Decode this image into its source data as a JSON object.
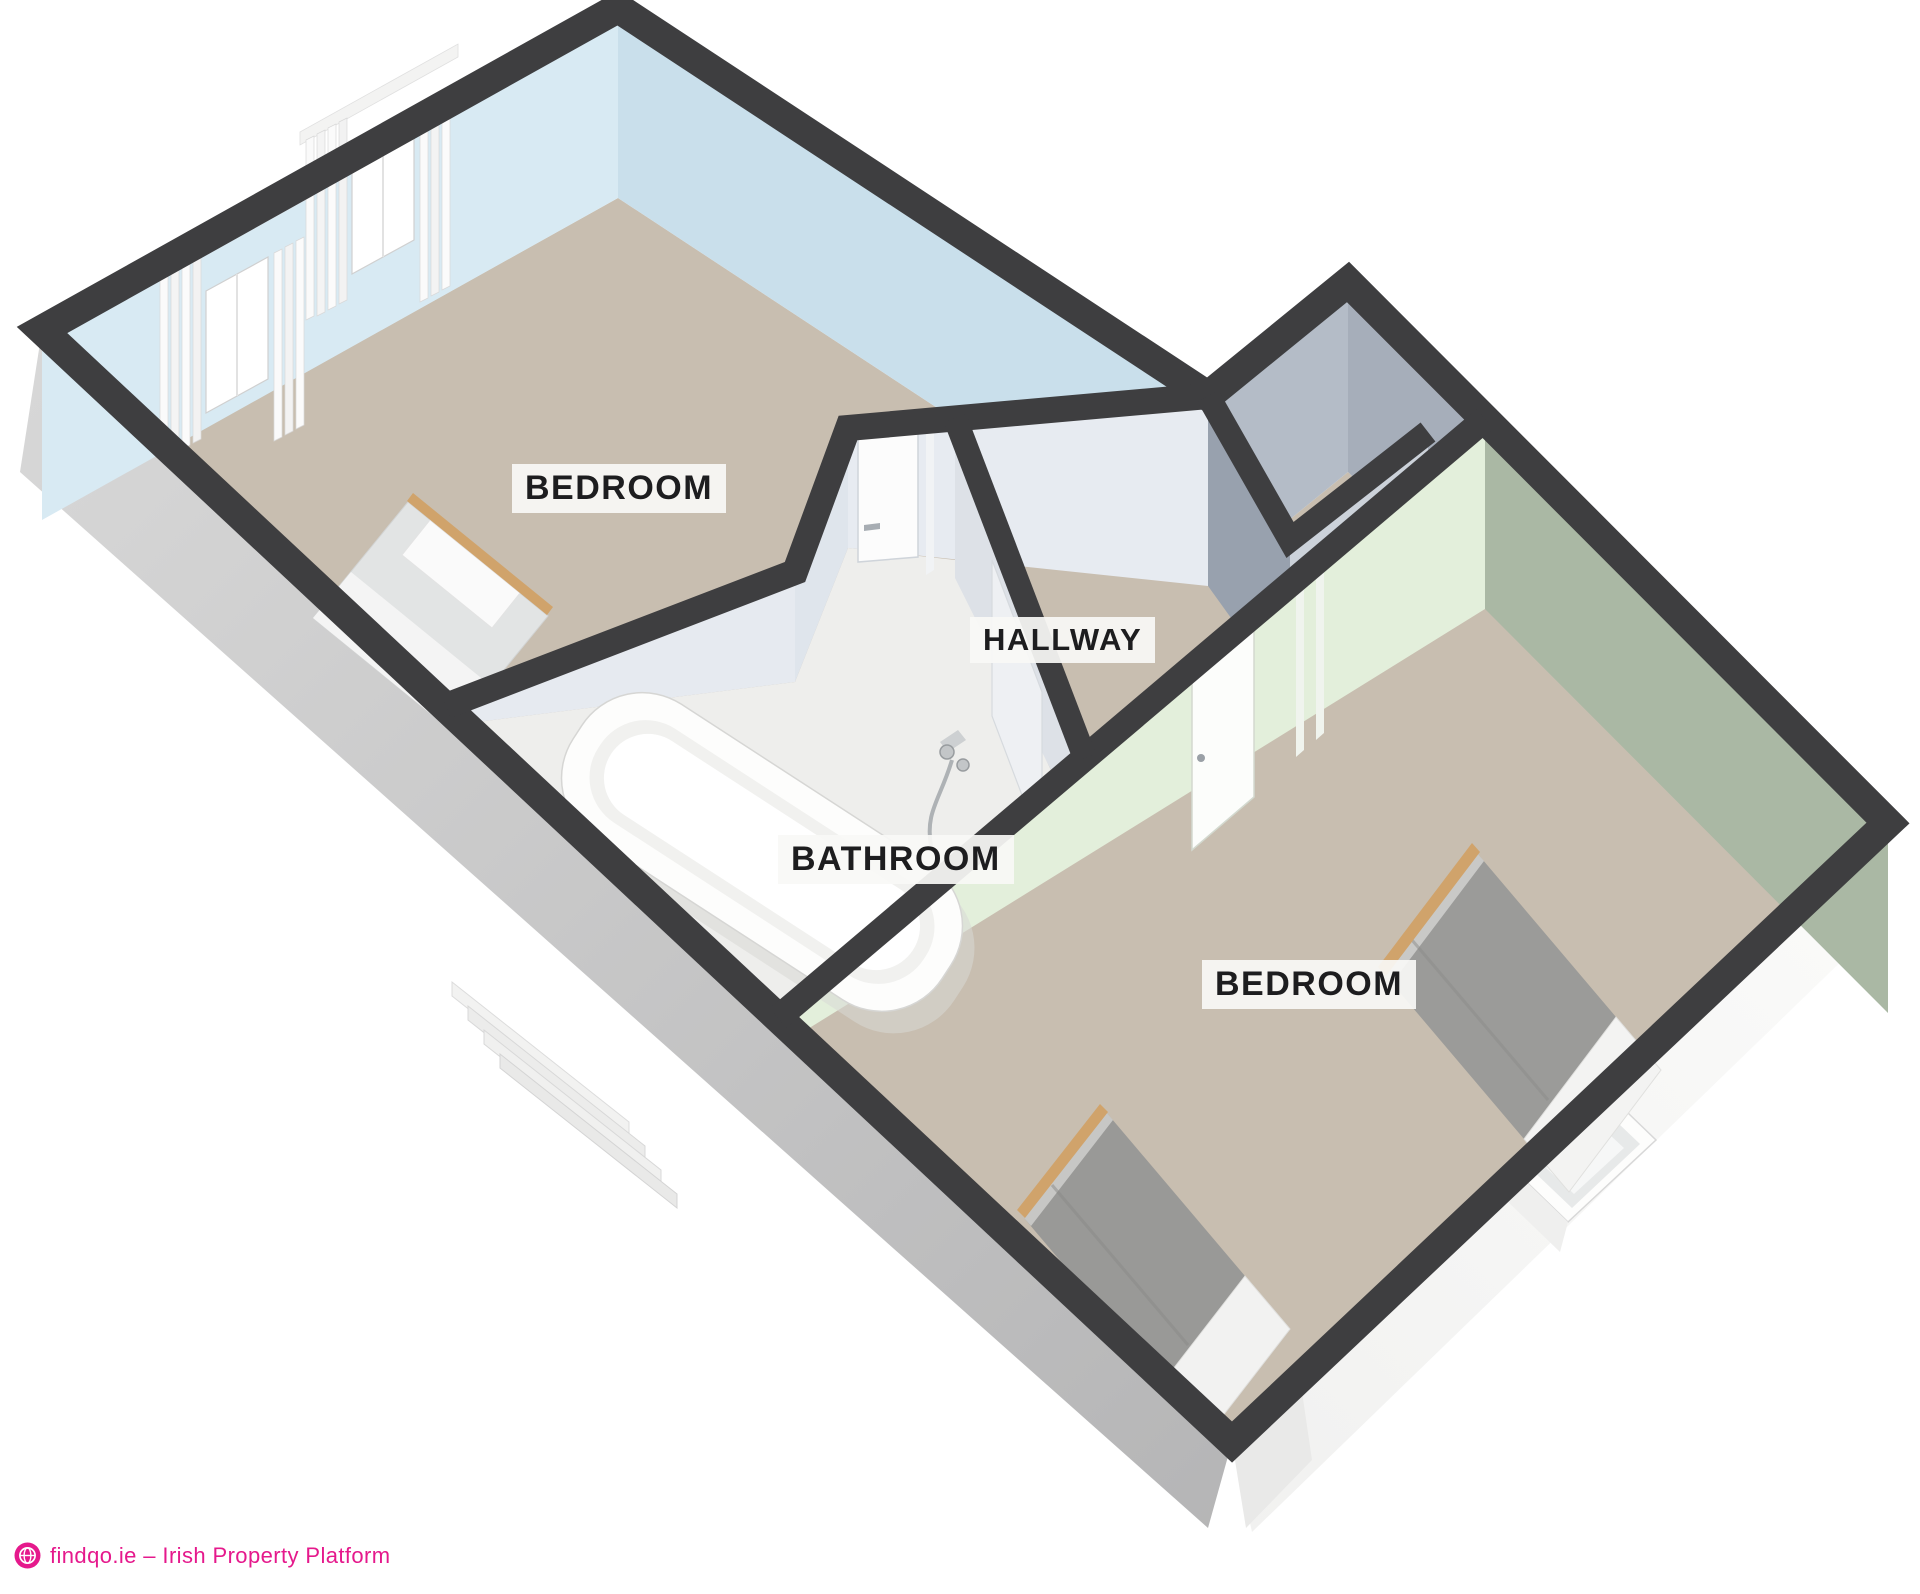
{
  "page": {
    "background": "#ffffff",
    "content_type": "3d-floor-plan-render"
  },
  "floorplan": {
    "rooms": [
      {
        "id": "bedroom-1",
        "label": "BEDROOM"
      },
      {
        "id": "hallway",
        "label": "HALLWAY"
      },
      {
        "id": "bathroom",
        "label": "BATHROOM"
      },
      {
        "id": "bedroom-2",
        "label": "BEDROOM"
      }
    ],
    "furniture": [
      "double-bed",
      "bathtub",
      "single-bed",
      "single-bed"
    ],
    "features": [
      "windows-with-curtains",
      "doors",
      "exterior-stairs",
      "recessed-window"
    ],
    "colors": {
      "wall_cap": "#3e3e40",
      "carpet": "#c8beb0",
      "bathroom_floor": "#eeeeec",
      "wall_blue_nw": "#d8eaf3",
      "wall_blue_ne": "#c9dfeb",
      "wall_gray_light": "#e7ebf1",
      "wall_slate": "#a6aeba",
      "wall_slate_dark": "#9aa3b0",
      "wall_green_light": "#e3efdb",
      "wall_green_shaded": "#aab8a4",
      "exterior_sw": "#c6c6c7",
      "exterior_se": "#f7f7f6",
      "wood": "#d0a36b",
      "bed_gray": "#9b9b99",
      "label_bg": "rgba(248,248,246,0.92)",
      "label_text": "#1d1d1f"
    }
  },
  "branding": {
    "icon": "globe-icon",
    "logo_text": "findqo.ie – Irish Property Platform",
    "brand_color": "#e5198c"
  }
}
